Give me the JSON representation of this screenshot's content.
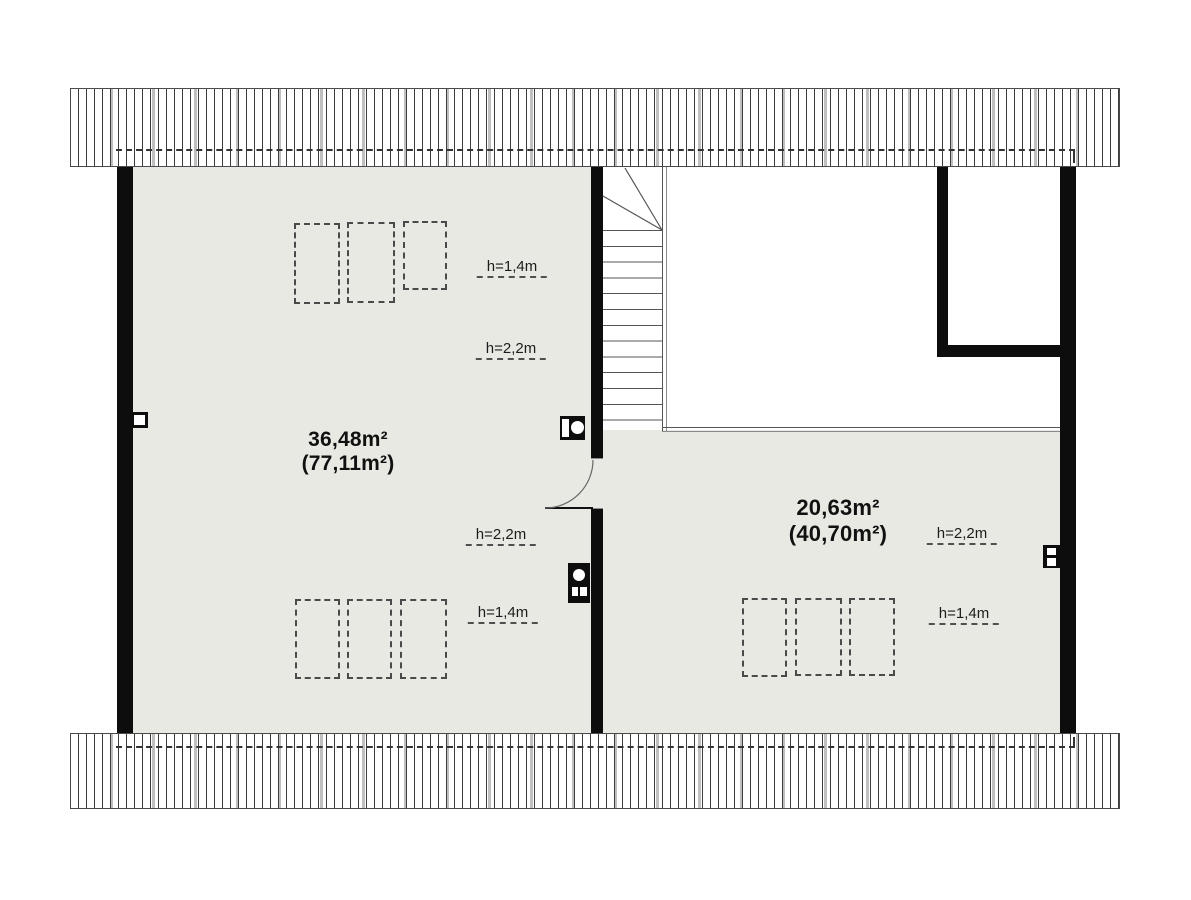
{
  "rooms": [
    {
      "id": "left-room",
      "area": "36,48m²",
      "floor_area": "(77,11m²)"
    },
    {
      "id": "right-room",
      "area": "20,63m²",
      "floor_area": "(40,70m²)"
    }
  ],
  "height_labels": [
    {
      "id": "left-room-top",
      "text": "h=1,4m"
    },
    {
      "id": "left-room-upper-mid",
      "text": "h=2,2m"
    },
    {
      "id": "left-room-lower-mid",
      "text": "h=2,2m"
    },
    {
      "id": "left-room-bottom",
      "text": "h=1,4m"
    },
    {
      "id": "right-room-mid",
      "text": "h=2,2m"
    },
    {
      "id": "right-room-bottom",
      "text": "h=1,4m"
    }
  ],
  "colors": {
    "floor": "#e9e9e4",
    "wall": "#0d0d0d",
    "hatch_line": "#3c3c3c",
    "dashed_line": "#4a4a4a"
  }
}
